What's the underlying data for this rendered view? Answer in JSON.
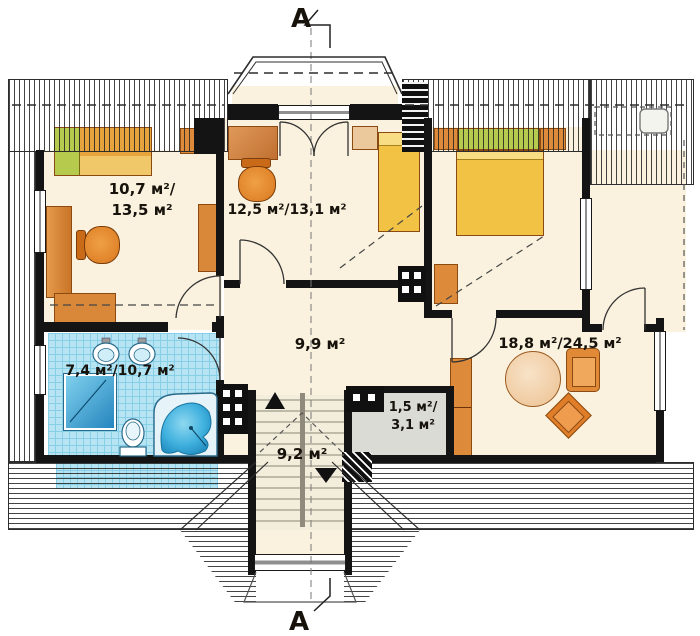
{
  "drawing": {
    "type": "attic floor plan",
    "section": {
      "top_label": "A",
      "bottom_label": "A"
    }
  },
  "rooms": [
    {
      "name": "bedroom-left",
      "label_line1": "10,7 м²/",
      "label_line2": "13,5 м²"
    },
    {
      "name": "bedroom-center",
      "label_line1": "12,5 м²/13,1 м²"
    },
    {
      "name": "hall",
      "label_line1": "9,9 м²"
    },
    {
      "name": "bathroom",
      "label_line1": "7,4 м²/10,7 м²"
    },
    {
      "name": "living-room",
      "label_line1": "18,8 м²/24,5 м²"
    },
    {
      "name": "closet",
      "label_line1": "1,5 м²/",
      "label_line2": "3,1 м²"
    },
    {
      "name": "staircase",
      "label_line1": "9,2 м²"
    }
  ],
  "colors": {
    "wall": "#141414",
    "floor": "#faf2de",
    "tile": "#b7e4f3",
    "furniture-orange": "#e2883c",
    "bed-yellow": "#f2c245",
    "pillow-green": "#b6ca4d",
    "tub-blue": "#35aadc"
  }
}
